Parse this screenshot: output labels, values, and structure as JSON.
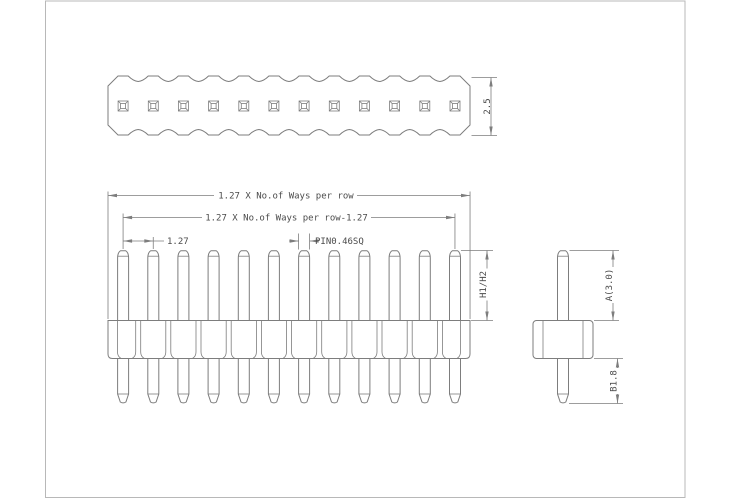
{
  "drawing": {
    "type": "pin-header-technical-drawing",
    "ways": 12,
    "labels": {
      "body_width": "2.5",
      "total_length": "1.27 X No.of Ways per row",
      "span_length": "1.27 X No.of Ways per row-1.27",
      "pitch": "1.27",
      "pin_size": "PIN0.46SQ",
      "mating_height": "H1/H2",
      "pin_above": "A(3.0)",
      "pin_below": "B1.8"
    },
    "colors": {
      "line": "#7d7d7d",
      "text": "#4b4b4b",
      "frame": "#b8b8b8",
      "bg": "#ffffff"
    }
  }
}
